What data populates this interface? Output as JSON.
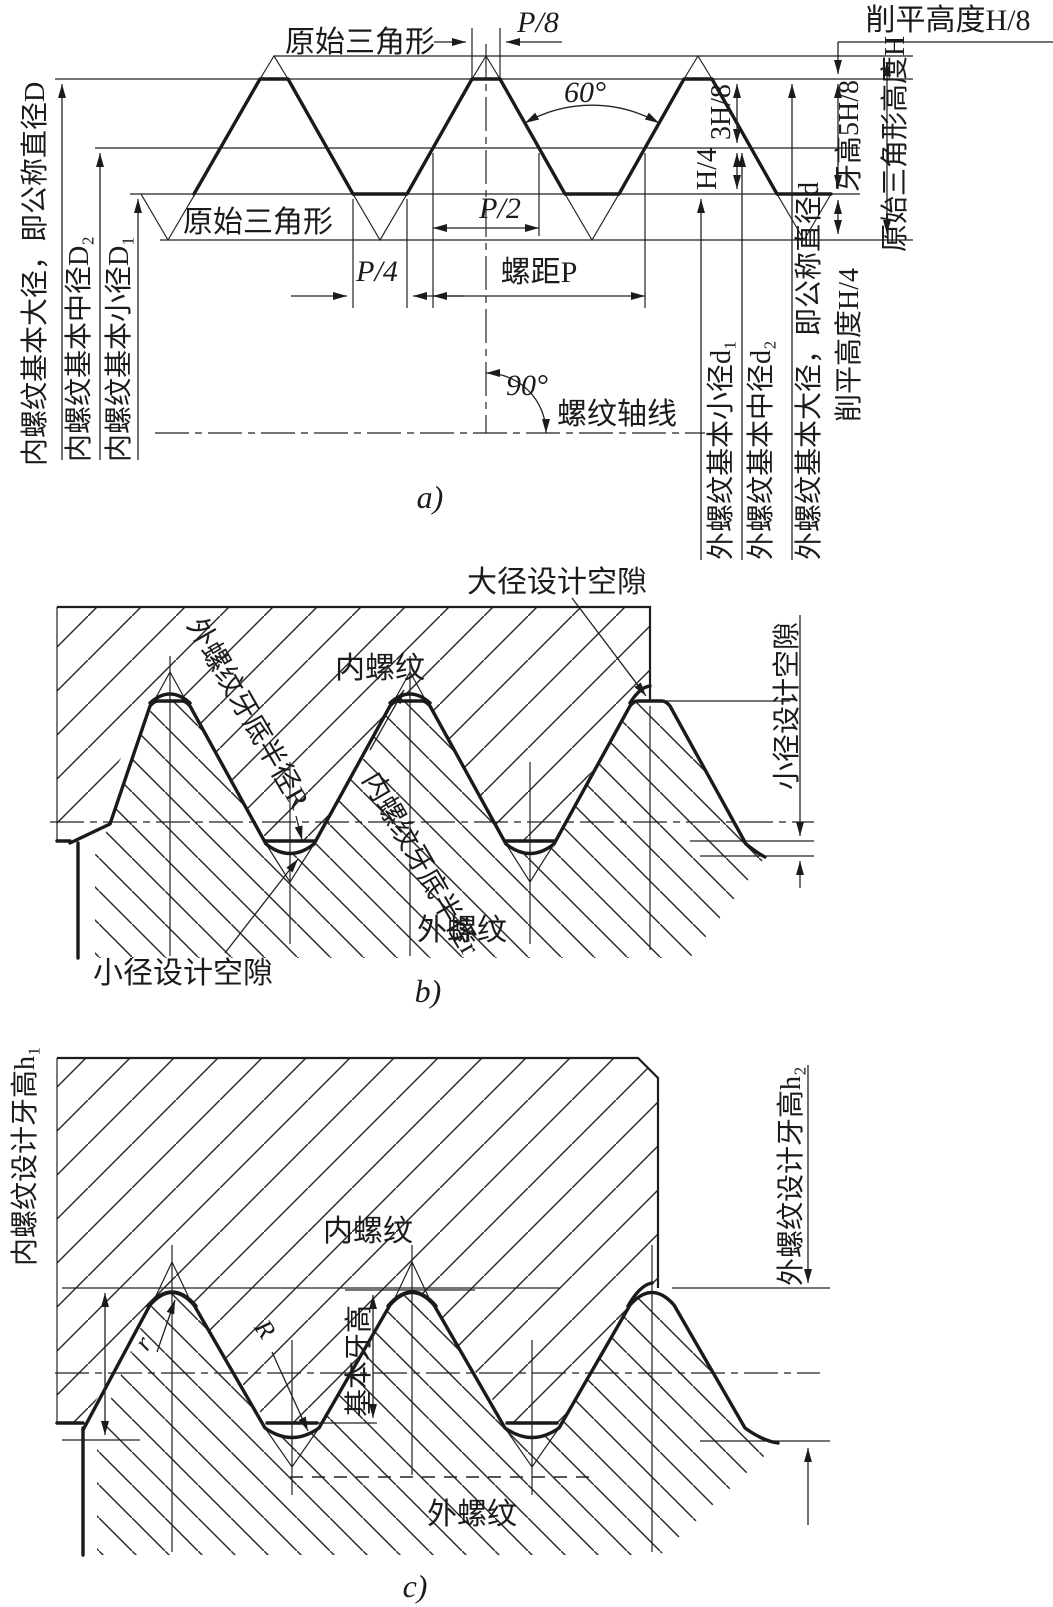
{
  "page": {
    "background": "#ffffff",
    "ink": "#1b1b1b"
  },
  "a": {
    "caption": "a)",
    "left": [
      "内螺纹基本大径，即公称直径D",
      "内螺纹基本中径D₂",
      "内螺纹基本小径D₁"
    ],
    "right": [
      "外螺纹基本小径d₁",
      "外螺纹基本中径d₂",
      "外螺纹基本大径，即公称直径d"
    ],
    "tooth_height": "牙高5H/8",
    "flat_height_quarter": "削平高度H/4",
    "triangle_height": "原始三角形高度H",
    "flat_height_eighth": "削平高度H/8",
    "original_triangle_top": "原始三角形",
    "original_triangle_lower": "原始三角形",
    "p8": "P/8",
    "p4": "P/4",
    "p2": "P/2",
    "pitch": "螺距P",
    "h38": "3H/8",
    "h14": "H/4",
    "deg60": "60°",
    "deg90": "90°",
    "axis": "螺纹轴线"
  },
  "b": {
    "caption": "b)",
    "major_clearance": "大径设计空隙",
    "internal": "内螺纹",
    "external": "外螺纹",
    "ext_root_radius": "外螺纹牙底半径R",
    "int_root_radius": "内螺纹牙底半径r",
    "minor_clearance_left": "小径设计空隙",
    "minor_clearance_right": "小径设计空隙"
  },
  "c": {
    "caption": "c)",
    "int_design_height": "内螺纹设计牙高h₁",
    "ext_design_height": "外螺纹设计牙高h₂",
    "basic_height": "基本牙高",
    "internal": "内螺纹",
    "external": "外螺纹",
    "r_label": "r",
    "R_label": "R"
  }
}
